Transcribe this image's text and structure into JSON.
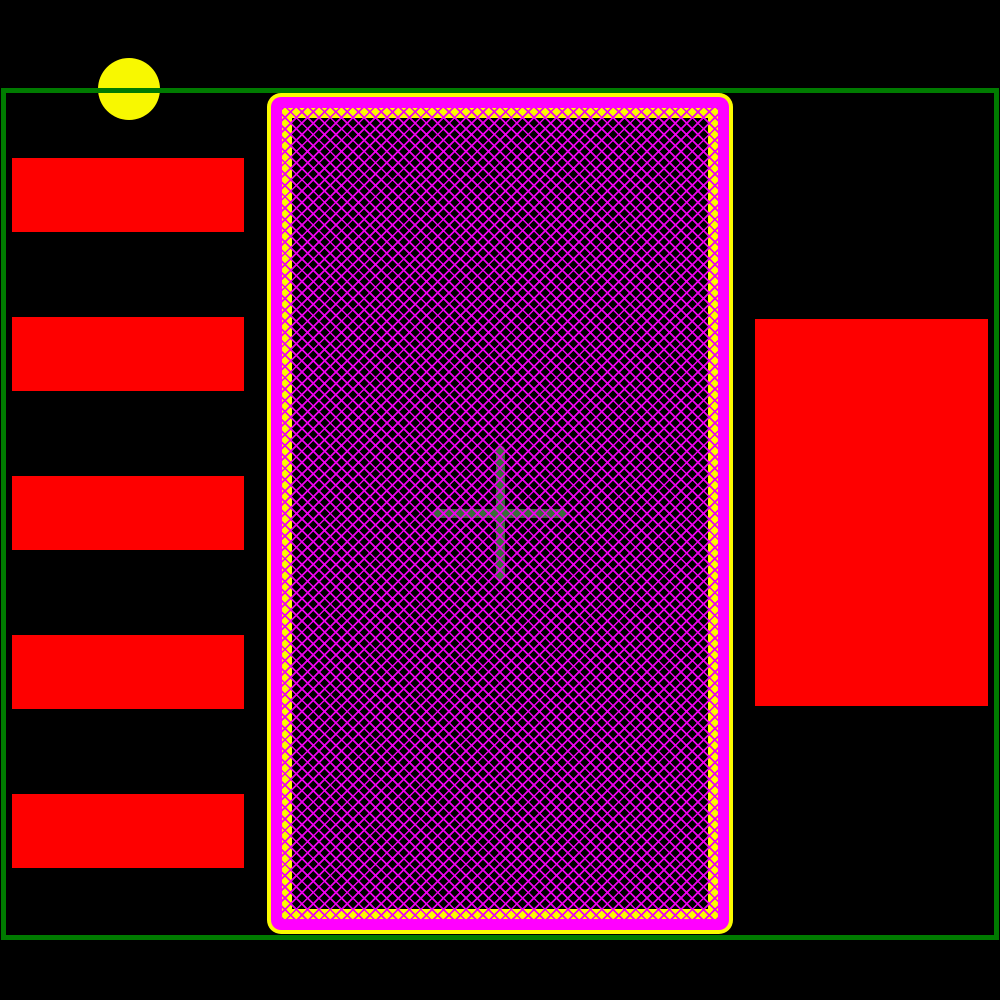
{
  "canvas": {
    "width": 1000,
    "height": 1000,
    "background": "#000000"
  },
  "colors": {
    "background": "#000000",
    "courtyard_green": "#007B00",
    "pad_red": "#FE0000",
    "paste_yellow": "#FBFB00",
    "mask_magenta": "#FF00FF",
    "hatch_magenta": "#EE00EE",
    "origin_cross_green": "#3A6B3A",
    "pin1_yellow": "#F8F800"
  },
  "footprint": {
    "courtyard": {
      "x": 1,
      "y": 88,
      "width": 998,
      "height": 852,
      "stroke": 5
    },
    "pin1_marker": {
      "cx": 129,
      "cy": 89,
      "r": 31
    },
    "left_pads": {
      "x": 12,
      "width": 232,
      "height": 74,
      "tops": [
        158,
        317,
        476,
        635,
        794
      ]
    },
    "right_pad": {
      "x": 755,
      "y": 319,
      "width": 233,
      "height": 387
    },
    "thermal_pad": {
      "x": 267,
      "y": 93,
      "width": 466,
      "height": 841,
      "paste_outline": 4,
      "mask_ring": 11,
      "hatch_ring": 10,
      "hatch_pitch": 8,
      "hatch_line": 1.7,
      "corner_radius": 14
    },
    "origin_cross": {
      "cx": 500,
      "cy": 513,
      "arm": 134,
      "stroke": 9
    }
  }
}
